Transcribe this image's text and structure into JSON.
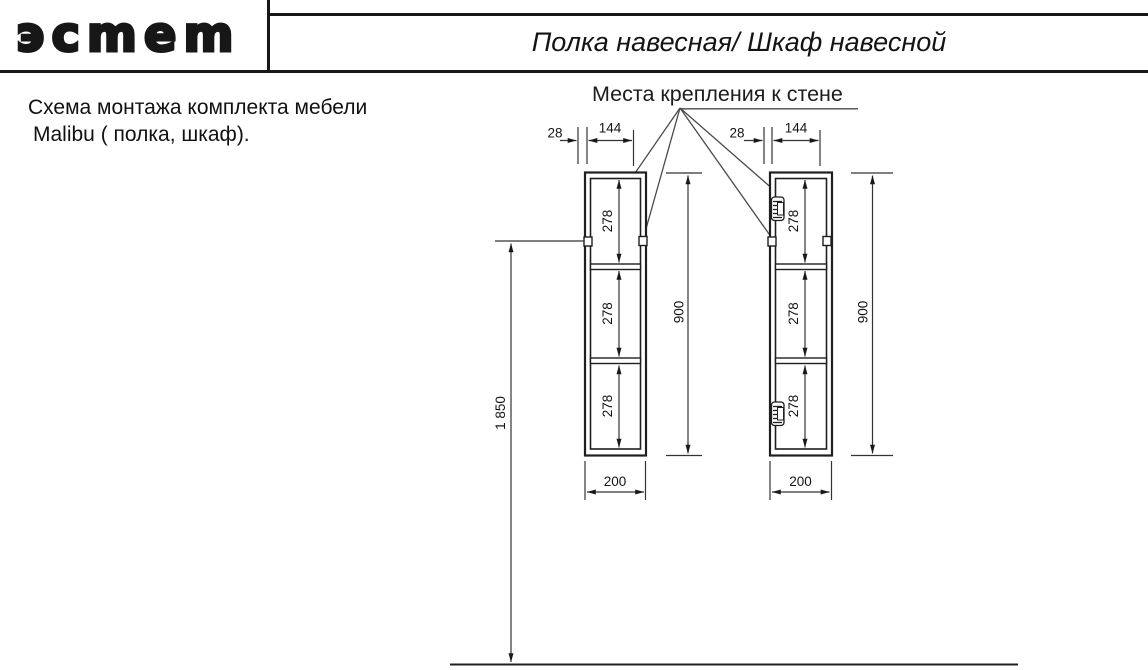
{
  "header": {
    "logo": "эсmem",
    "title": "Полка навесная/ Шкаф навесной"
  },
  "note": {
    "line1": "Схема монтажа комплекта мебели",
    "line2": "Malibu ( полка, шкаф)."
  },
  "callout": "Места крепления к стене",
  "dimensions": {
    "hook_inset": "28",
    "hook_spacing": "144",
    "section_height": "278",
    "unit_height": "900",
    "unit_width": "200",
    "mount_height": "1 850"
  },
  "colors": {
    "ink": "#171717",
    "dimension_line": "#333333"
  }
}
